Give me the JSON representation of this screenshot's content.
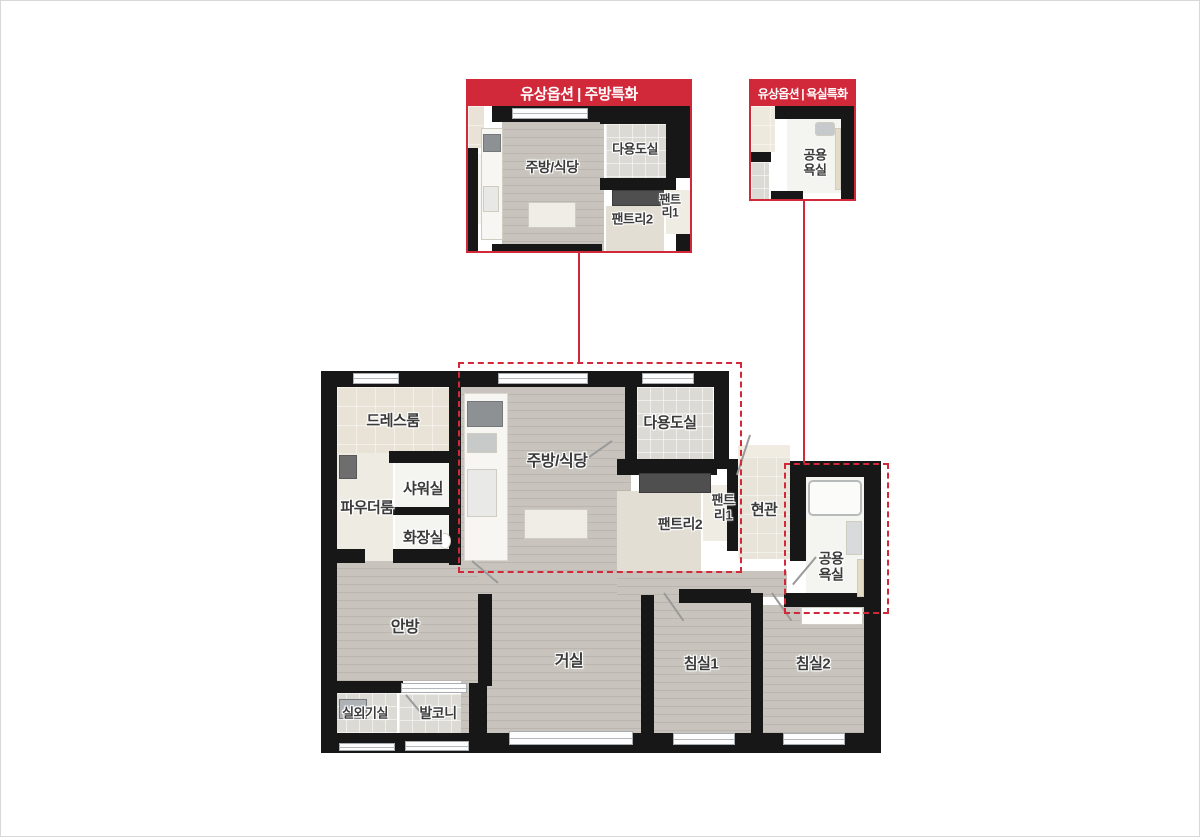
{
  "colors": {
    "accent_red": "#d1293a",
    "wall_black": "#171717",
    "wood_floor": "#c4c0b9",
    "tile_grey": "#dcdad4",
    "cream_tile": "#e8e3d6",
    "label_text": "#3b3b3b"
  },
  "insets": {
    "kitchen": {
      "title": "유상옵션 | 주방특화",
      "labels": {
        "kitchen": "주방/식당",
        "utility": "다용도실",
        "pantry2": "팬트리2",
        "pantry1_l1": "팬트",
        "pantry1_l2": "리1"
      }
    },
    "bath": {
      "title": "유상옵션 | 욕실특화",
      "labels": {
        "bath_l1": "공용",
        "bath_l2": "욕실"
      }
    }
  },
  "floorplan": {
    "labels": {
      "dress": "드레스룸",
      "powder": "파우더룸",
      "shower": "샤워실",
      "toilet": "화장실",
      "kitchen": "주방/식당",
      "utility": "다용도실",
      "pantry2": "팬트리2",
      "pantry1_l1": "팬트",
      "pantry1_l2": "리1",
      "entry": "현관",
      "bath_l1": "공용",
      "bath_l2": "욕실",
      "master": "안방",
      "outdoor": "실외기실",
      "balcony": "발코니",
      "living": "거실",
      "bed1": "침실1",
      "bed2": "침실2"
    }
  }
}
